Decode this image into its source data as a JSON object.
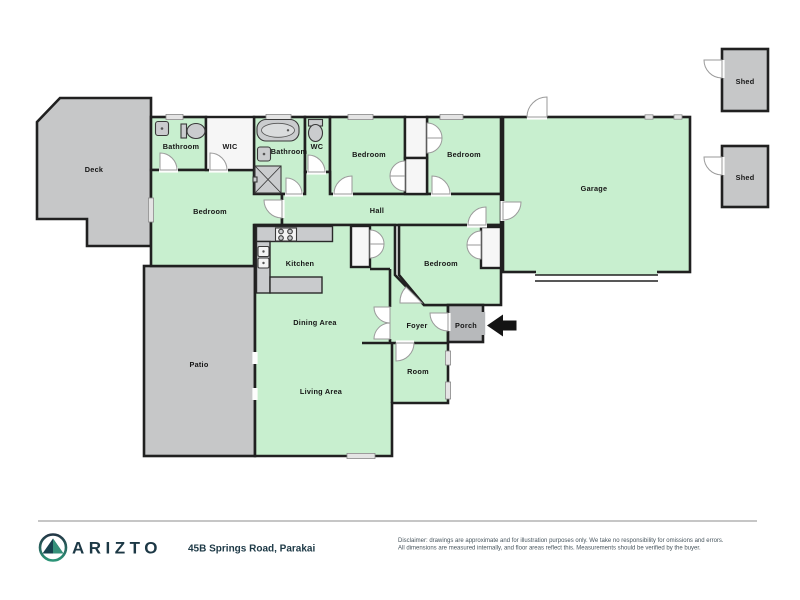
{
  "floorplan": {
    "rooms": {
      "deck": "Deck",
      "bathroom_ensuite": "Bathroom",
      "wic": "WIC",
      "bathroom_main": "Bathroom",
      "wc": "WC",
      "bedroom_top_left": "Bedroom",
      "bedroom_top_right": "Bedroom",
      "garage": "Garage",
      "shed_top": "Shed",
      "shed_bottom": "Shed",
      "bedroom_master": "Bedroom",
      "hall": "Hall",
      "kitchen": "Kitchen",
      "bedroom_middle": "Bedroom",
      "dining": "Dining Area",
      "foyer": "Foyer",
      "porch": "Porch",
      "room": "Room",
      "living": "Living Area",
      "patio": "Patio"
    },
    "entrance_arrow_direction": "left",
    "colors": {
      "room_fill": "#c8efcf",
      "outdoor_fill": "#c6c7c8",
      "porch_fill": "#b7b9bb",
      "white_room_fill": "#f6f6f6",
      "wall": "#202020"
    }
  },
  "footer": {
    "brand": "ARIZTO",
    "address": "45B Springs Road, Parakai",
    "disclaimer_line1": "Disclaimer: drawings are approximate and for illustration purposes only. We take no responsibility for omissions and errors.",
    "disclaimer_line2": "All dimensions are measured internally, and floor areas reflect this. Measurements should be verified by the buyer."
  }
}
